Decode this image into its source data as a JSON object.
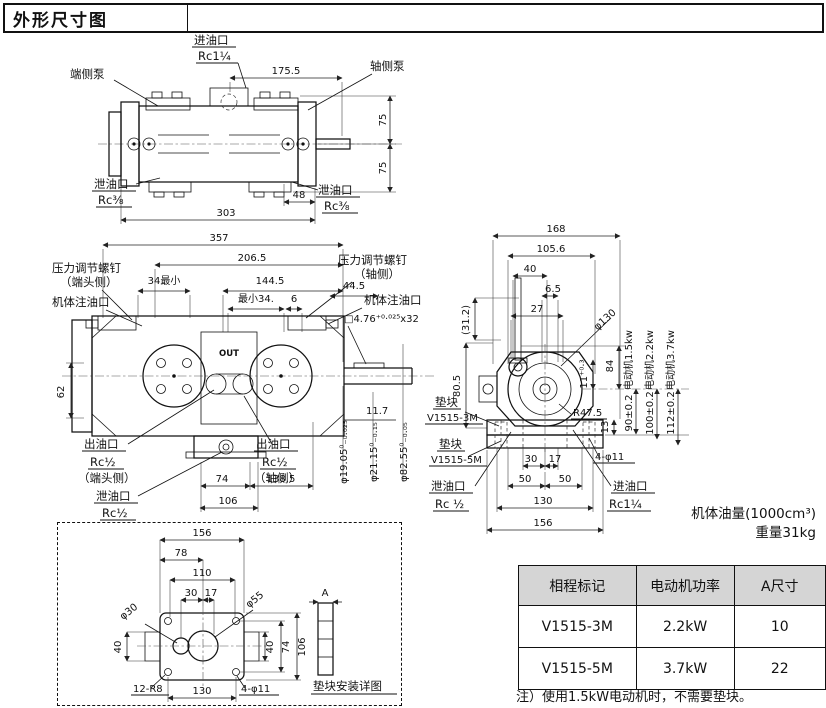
{
  "title": "外形尺寸图",
  "top_view": {
    "inlet_label": "进油口",
    "inlet_size": "Rc1¼",
    "end_pump": "端侧泵",
    "shaft_pump": "轴侧泵",
    "drain_label_left": "泄油口",
    "drain_size_left": "Rc⅜",
    "drain_label_right": "泄油口",
    "drain_size_right": "Rc⅜",
    "dim_175_5": "175.5",
    "dim_75_top": "75",
    "dim_75_bottom": "75",
    "dim_48": "48",
    "dim_303": "303"
  },
  "front_view": {
    "dim_357": "357",
    "dim_206_5": "206.5",
    "dim_34_min": "34最小",
    "dim_144_5": "144.5",
    "dim_min_34": "最小34.",
    "dim_6": "6",
    "dim_44_5": "44.5",
    "screw_end_line1": "压力调节螺钉",
    "screw_end_line2": "（端头侧）",
    "screw_shaft_line1": "压力调节螺钉",
    "screw_shaft_line2": "（轴侧）",
    "fill_port_left": "机体注油口",
    "fill_port_right": "机体注油口",
    "key_dim": "□4.76⁺⁰·⁰²⁵x32",
    "dim_62": "62",
    "dim_11_7": "11.7",
    "out_marking": "OUT",
    "outlet_left_line1": "出油口",
    "outlet_left_line2": "Rc½",
    "outlet_left_line3": "（端头侧）",
    "drain_line1": "泄油口",
    "drain_line2": "Rc½",
    "outlet_right_line1": "出油口",
    "outlet_right_line2": "Rc½",
    "outlet_right_line3": "（轴侧）",
    "dim_74": "74",
    "dim_138_5": "138.5",
    "dim_106": "106",
    "dia_19": "φ19.05⁰₋₀.₀₂₅",
    "dia_21": "φ21.15⁰₋₀.₁₅",
    "dia_82": "φ82.55⁰₋₀.₀₅"
  },
  "side_view": {
    "dim_168": "168",
    "dim_105_6": "105.6",
    "dim_40": "40",
    "dim_6_5": "6.5",
    "dim_27": "27",
    "dim_31_2": "(31.2)",
    "dim_80_5": "80.5",
    "dia_130": "φ130",
    "r_47_5": "R47.5",
    "dim_11": "11⁺⁰·³",
    "dim_84": "84",
    "dim_13": "13",
    "motor_1_5": "电动机1.5kw",
    "motor_2_2": "电动机2.2kw",
    "motor_3_7": "电动机3.7kw",
    "dim_90": "90±0.2",
    "dim_100": "100±0.2",
    "dim_112": "112±0.2",
    "spacer1_line1": "垫块",
    "spacer1_line2": "V1515-3M",
    "spacer2_line1": "垫块",
    "spacer2_line2": "V1515-5M",
    "drain_line1": "泄油口",
    "drain_line2": "Rc ½",
    "inlet_line1": "进油口",
    "inlet_line2": "Rc1¼",
    "bolt_holes": "4-φ11",
    "dim_30": "30",
    "dim_17": "17",
    "dim_50a": "50",
    "dim_50b": "50",
    "dim_130": "130",
    "dim_156": "156"
  },
  "detail_view": {
    "dim_156": "156",
    "dim_78": "78",
    "dim_110": "110",
    "dim_30": "30",
    "dim_17": "17",
    "dia_30": "φ30",
    "dia_55": "φ55",
    "dim_40_left": "40",
    "dim_40_right": "40",
    "dim_74": "74",
    "dim_106": "106",
    "corner_radius": "12-R8",
    "dim_130": "130",
    "bolt_holes": "4-φ11",
    "dim_a": "A",
    "caption": "垫块安装详图"
  },
  "capacity": {
    "line1": "机体油量(1000cm³)",
    "line2": "重量31kg"
  },
  "table": {
    "headers": [
      "相程标记",
      "电动机功率",
      "A尺寸"
    ],
    "rows": [
      [
        "V1515-3M",
        "2.2kW",
        "10"
      ],
      [
        "V1515-5M",
        "3.7kW",
        "22"
      ]
    ]
  },
  "note": "注）使用1.5kW电动机时，不需要垫块。"
}
